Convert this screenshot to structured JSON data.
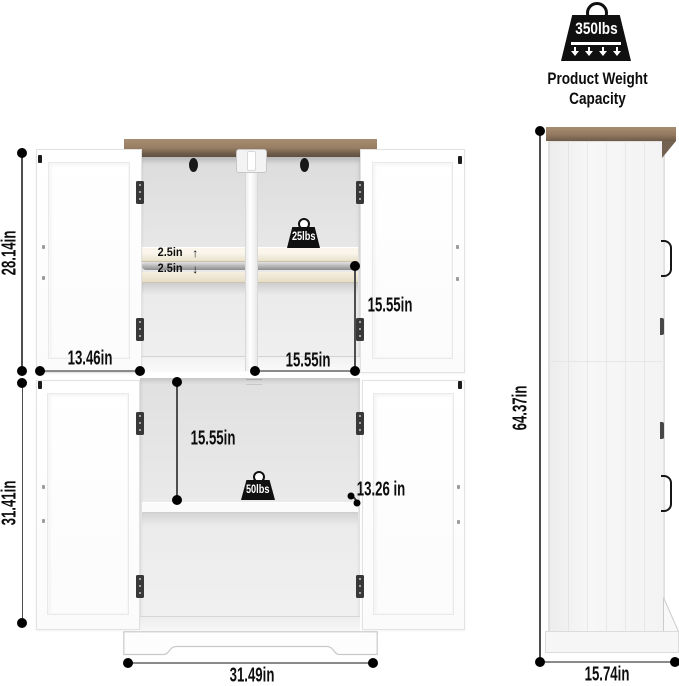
{
  "capacity": {
    "weight": "350lbs",
    "caption": "Product Weight Capacity"
  },
  "front": {
    "upper_section_height": "28.14in",
    "lower_section_height": "31.41in",
    "door_width": "13.46in",
    "upper_compartment_height": "15.55in",
    "upper_compartment_width": "15.55in",
    "lower_compartment_height": "15.55in",
    "shelf_depth": "13.26 in",
    "cabinet_width": "31.49in",
    "shelf_adjust_up": "2.5in",
    "shelf_adjust_down": "2.5in",
    "upper_shelf_capacity": "25lbs",
    "lower_shelf_capacity": "50lbs"
  },
  "side": {
    "height": "64.37in",
    "depth": "15.74in"
  },
  "icons": {
    "arrow_up": "↑",
    "arrow_down": "↓"
  },
  "colors": {
    "wood": "#9a8068",
    "wood_dark": "#6d5b49",
    "line": "#4e4e4e",
    "black": "#101010"
  }
}
